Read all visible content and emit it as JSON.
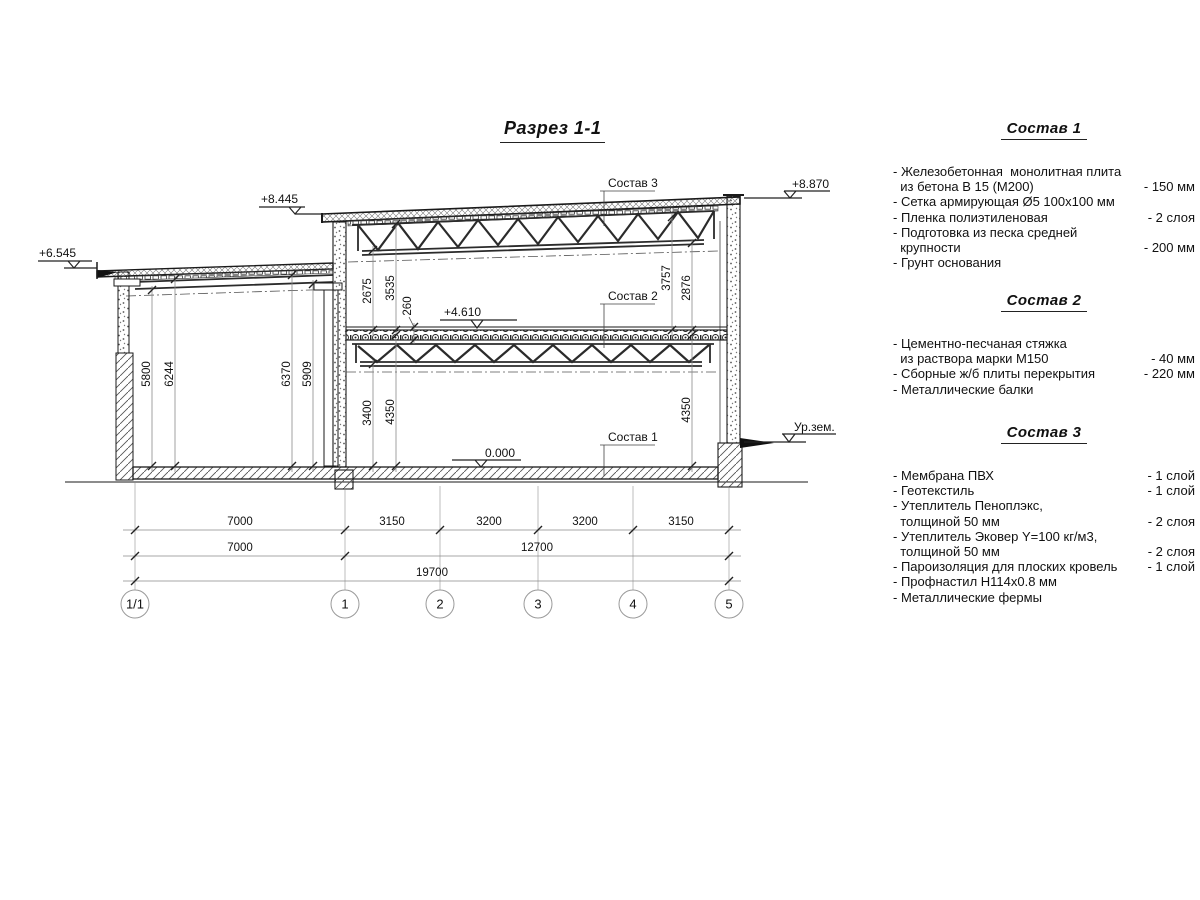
{
  "title": "Разрез 1-1",
  "drawing": {
    "labels": {
      "sostav1": "Состав 1",
      "sostav2": "Состав 2",
      "sostav3": "Состав 3"
    },
    "elevations": {
      "annex_roof": "+6.545",
      "main_roof": "+8.445",
      "parapet": "+8.870",
      "mid_floor": "+4.610",
      "zero": "0.000",
      "ground": "Ур.зем."
    },
    "vdims": {
      "d5800": "5800",
      "d6244": "6244",
      "d6370": "6370",
      "d5909": "5909",
      "d2675": "2675",
      "d3535": "3535",
      "d260": "260",
      "d3400": "3400",
      "d4350a": "4350",
      "d3757": "3757",
      "d2876": "2876",
      "d4350b": "4350"
    },
    "hdims": {
      "r1": [
        "7000",
        "3150",
        "3200",
        "3200",
        "3150"
      ],
      "r2": [
        "7000",
        "12700"
      ],
      "r3": [
        "19700"
      ]
    },
    "axes": [
      "1/1",
      "1",
      "2",
      "3",
      "4",
      "5"
    ]
  },
  "compositions": [
    {
      "title": "Состав 1",
      "items": [
        {
          "text": "- Железобетонная  монолитная плита\n  из бетона В 15 (М200)",
          "value": "- 150 мм"
        },
        {
          "text": "- Сетка армирующая Ø5 100х100 мм",
          "value": ""
        },
        {
          "text": "- Пленка полиэтиленовая",
          "value": "-  2 слоя"
        },
        {
          "text": "- Подготовка из песка средней\n  крупности",
          "value": "- 200 мм"
        },
        {
          "text": "- Грунт основания",
          "value": ""
        }
      ]
    },
    {
      "title": "Состав 2",
      "items": [
        {
          "text": "- Цементно-песчаная стяжка\n  из раствора марки М150",
          "value": "- 40 мм"
        },
        {
          "text": "- Сборные ж/б плиты перекрытия",
          "value": "- 220 мм"
        },
        {
          "text": "- Металлические балки",
          "value": ""
        }
      ]
    },
    {
      "title": "Состав 3",
      "items": [
        {
          "text": "- Мембрана ПВХ",
          "value": "- 1 слой"
        },
        {
          "text": "- Геотекстиль",
          "value": "- 1 слой"
        },
        {
          "text": "- Утеплитель Пеноплэкс,\n  толщиной 50 мм",
          "value": "- 2 слоя"
        },
        {
          "text": "- Утеплитель Эковер Y=100 кг/м3,\n  толщиной 50 мм",
          "value": "- 2 слоя"
        },
        {
          "text": "- Пароизоляция для плоских кровель",
          "value": "- 1 слой"
        },
        {
          "text": "- Профнастил Н114х0.8 мм",
          "value": ""
        },
        {
          "text": "- Металлические фермы",
          "value": ""
        }
      ]
    }
  ]
}
